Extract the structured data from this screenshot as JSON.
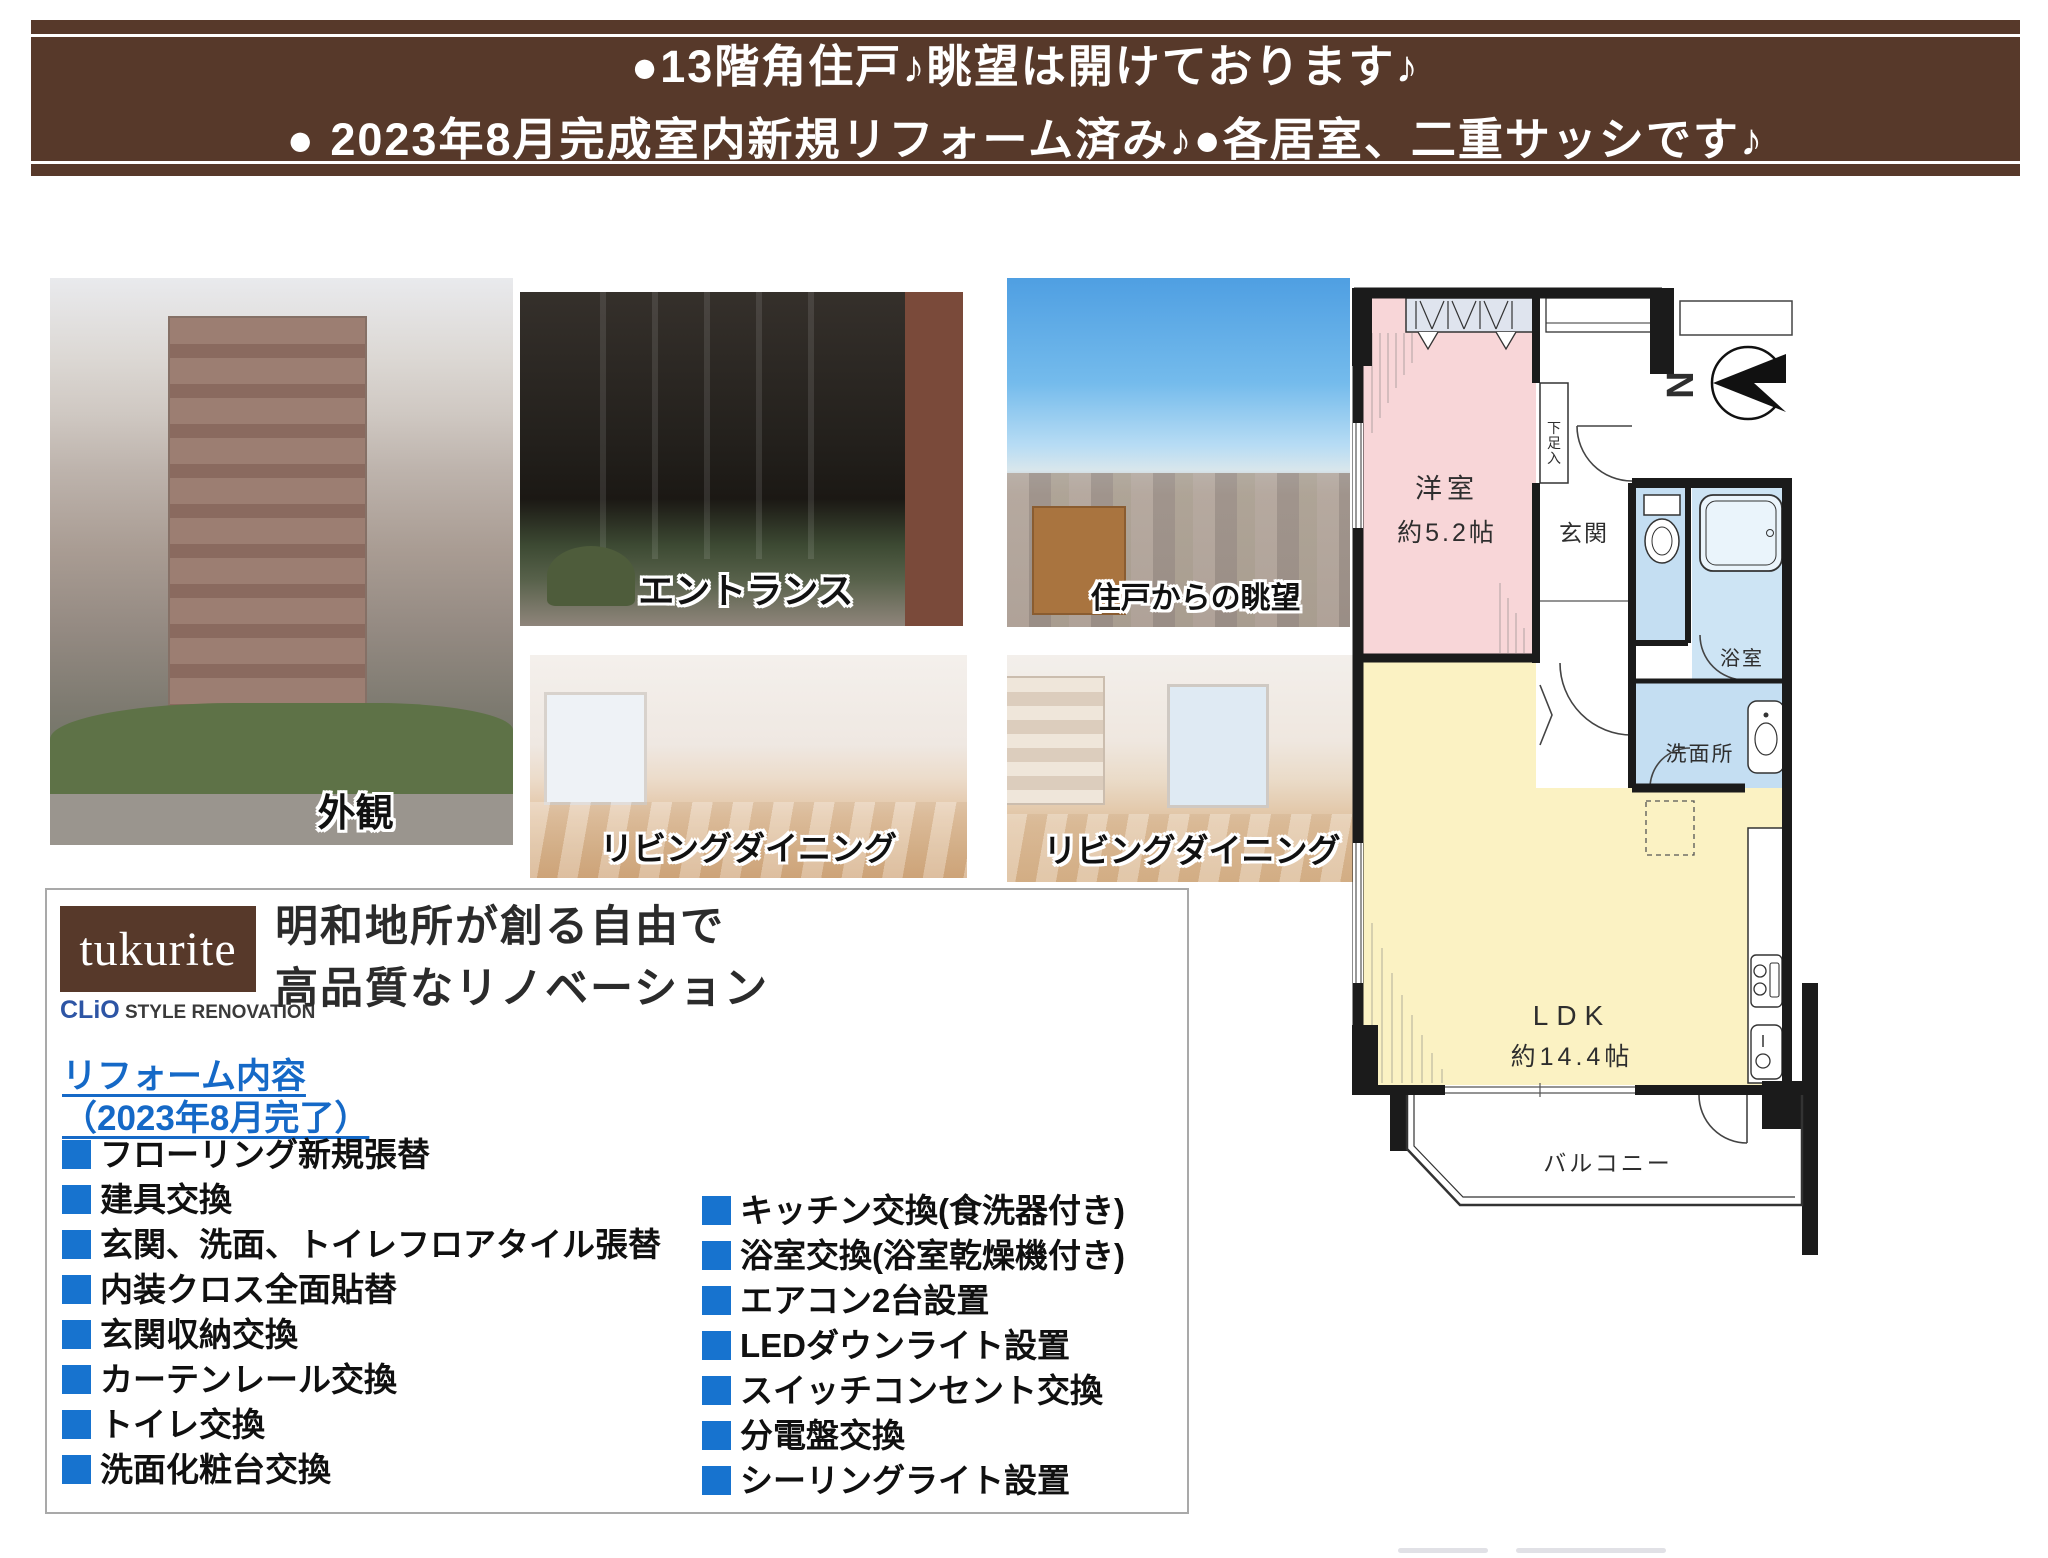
{
  "header": {
    "line1": "●13階角住戸♪眺望は開けております♪",
    "line2": "● 2023年8月完成室内新規リフォーム済み♪●各居室、二重サッシです♪"
  },
  "photos": [
    {
      "caption": "外観"
    },
    {
      "caption": "エントランス"
    },
    {
      "caption": "住戸からの眺望"
    },
    {
      "caption": "リビングダイニング"
    },
    {
      "caption": "リビングダイニング"
    }
  ],
  "brand": {
    "logo": "tukurite",
    "sub_blue": "CLiO",
    "sub_rest": " STYLE RENOVATION",
    "heading1": "明和地所が創る自由で",
    "heading2": "高品質なリノベーション"
  },
  "reform": {
    "title": "リフォーム内容",
    "subtitle": "（2023年8月完了）",
    "left": [
      "フローリング新規張替",
      "建具交換",
      "玄関、洗面、トイレフロアタイル張替",
      "内装クロス全面貼替",
      "玄関収納交換",
      "カーテンレール交換",
      "トイレ交換",
      "洗面化粧台交換"
    ],
    "right": [
      "キッチン交換(食洗器付き)",
      "浴室交換(浴室乾燥機付き)",
      "エアコン2台設置",
      "LEDダウンライト設置",
      "スイッチコンセント交換",
      "分電盤交換",
      "シーリングライト設置"
    ]
  },
  "floorplan": {
    "bedroom": "洋室",
    "bedroom_size": "約5.2帖",
    "shoe_cabinet": "下足入",
    "entrance": "玄関",
    "bath": "浴室",
    "washroom": "洗面所",
    "ldk": "LDK",
    "ldk_size": "約14.4帖",
    "balcony": "バルコニー",
    "north": "N"
  },
  "colors": {
    "header_brown": "#57392a",
    "bullet_blue": "#1773cf",
    "link_blue": "#1569c7",
    "room_pink": "#f8d6d8",
    "room_yellow": "#fbf2c3",
    "room_blue": "#c4def2",
    "closet_gray": "#dfe4ee",
    "wall_black": "#1b1b1b"
  }
}
